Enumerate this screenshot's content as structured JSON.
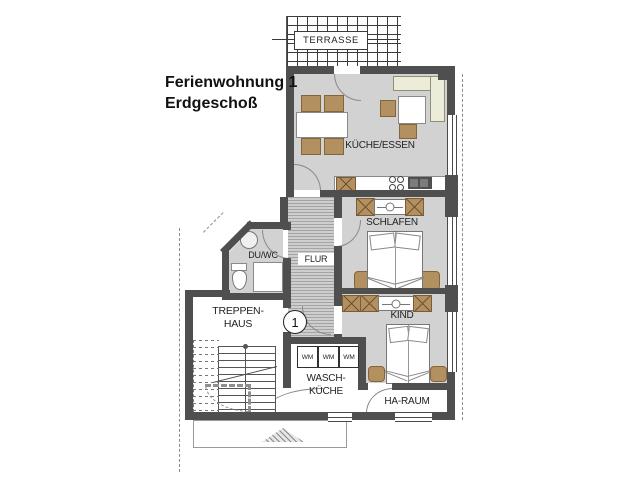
{
  "title": {
    "line1": "Ferienwohnung 1",
    "line2": "Erdgeschoß"
  },
  "unit_marker": {
    "number": "1"
  },
  "rooms": {
    "terrasse": {
      "label": "TERRASSE"
    },
    "kueche_essen": {
      "label": "KÜCHE/ESSEN"
    },
    "schlafen": {
      "label": "SCHLAFEN"
    },
    "kind": {
      "label": "KIND"
    },
    "flur": {
      "label": "FLUR"
    },
    "du_wc": {
      "label": "DU/WC"
    },
    "treppenhaus": {
      "label_line1": "TREPPEN-",
      "label_line2": "HAUS"
    },
    "wasch_kueche": {
      "label_line1": "WASCH-",
      "label_line2": "KÜCHE"
    },
    "ha_raum": {
      "label": "HA-RAUM"
    }
  },
  "appliances": {
    "washers": [
      {
        "label": "WM"
      },
      {
        "label": "WM"
      },
      {
        "label": "WM"
      }
    ]
  },
  "colors": {
    "wall": "#4f4f4f",
    "room_floor": "#d2d2d2",
    "flur_hatch_base": "#cecece",
    "furniture_wood": "#b3905f",
    "bench_cream": "#edecd9",
    "appliance_dark": "#4f4f4f",
    "background": "#ffffff",
    "text": "#1f1f1f"
  }
}
